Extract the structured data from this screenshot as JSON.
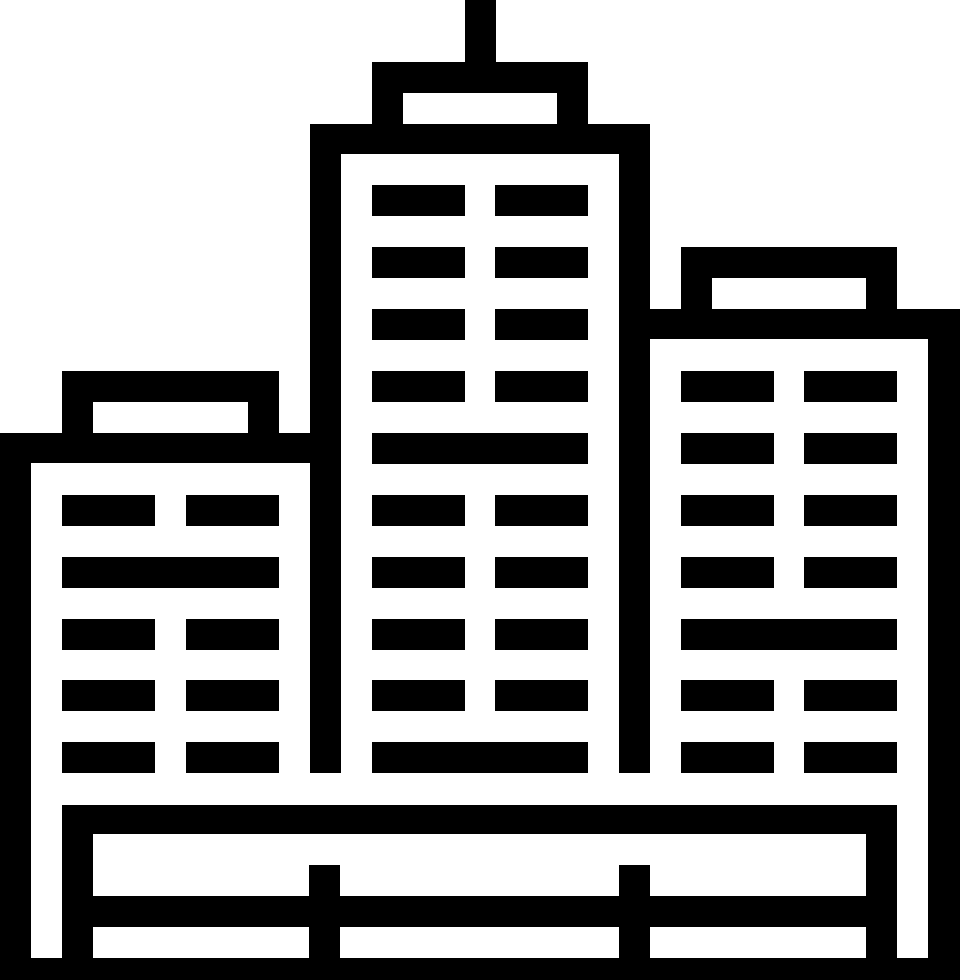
{
  "meta": {
    "canvas": {
      "width": 960,
      "height": 980
    }
  },
  "colors": {
    "foreground": "#000000",
    "background": "#ffffff"
  },
  "icon": {
    "name": "city-skyline-icon",
    "description": "Pixel-style monochrome icon of three city buildings: a tall center tower with rooftop antenna, a shorter left building, a mid-height right building, and a fence with ground band at the base.",
    "rects": [
      {
        "name": "right-building-body",
        "fill": "fg",
        "x": 650,
        "y": 309,
        "w": 310,
        "h": 649
      },
      {
        "name": "right-building-interior",
        "fill": "bg",
        "x": 650,
        "y": 339,
        "w": 278,
        "h": 619
      },
      {
        "name": "right-roof-box",
        "fill": "fg",
        "x": 681,
        "y": 247,
        "w": 216,
        "h": 62
      },
      {
        "name": "right-roof-box-opening",
        "fill": "bg",
        "x": 712,
        "y": 278,
        "w": 154,
        "h": 31
      },
      {
        "name": "center-building-body",
        "fill": "fg",
        "x": 310,
        "y": 124,
        "w": 340,
        "h": 649
      },
      {
        "name": "center-building-interior",
        "fill": "bg",
        "x": 341,
        "y": 154,
        "w": 278,
        "h": 619
      },
      {
        "name": "center-roof-cap",
        "fill": "fg",
        "x": 372,
        "y": 62,
        "w": 216,
        "h": 62
      },
      {
        "name": "center-roof-cap-opening",
        "fill": "bg",
        "x": 403,
        "y": 93,
        "w": 154,
        "h": 31
      },
      {
        "name": "antenna",
        "fill": "fg",
        "x": 465,
        "y": 0,
        "w": 31,
        "h": 62
      },
      {
        "name": "left-building-body",
        "fill": "fg",
        "x": 0,
        "y": 433,
        "w": 310,
        "h": 525
      },
      {
        "name": "left-building-interior",
        "fill": "bg",
        "x": 31,
        "y": 463,
        "w": 279,
        "h": 495
      },
      {
        "name": "left-roof-box",
        "fill": "fg",
        "x": 62,
        "y": 371,
        "w": 217,
        "h": 62
      },
      {
        "name": "left-roof-box-opening",
        "fill": "bg",
        "x": 93,
        "y": 402,
        "w": 155,
        "h": 31
      },
      {
        "name": "center-window",
        "fill": "fg",
        "x": 372,
        "y": 185,
        "w": 93,
        "h": 31
      },
      {
        "name": "center-window",
        "fill": "fg",
        "x": 495,
        "y": 185,
        "w": 93,
        "h": 31
      },
      {
        "name": "center-window",
        "fill": "fg",
        "x": 372,
        "y": 247,
        "w": 93,
        "h": 31
      },
      {
        "name": "center-window",
        "fill": "fg",
        "x": 495,
        "y": 247,
        "w": 93,
        "h": 31
      },
      {
        "name": "center-window",
        "fill": "fg",
        "x": 372,
        "y": 309,
        "w": 93,
        "h": 31
      },
      {
        "name": "center-window",
        "fill": "fg",
        "x": 495,
        "y": 309,
        "w": 93,
        "h": 31
      },
      {
        "name": "center-window",
        "fill": "fg",
        "x": 372,
        "y": 371,
        "w": 93,
        "h": 31
      },
      {
        "name": "center-window",
        "fill": "fg",
        "x": 495,
        "y": 371,
        "w": 93,
        "h": 31
      },
      {
        "name": "center-window-wide",
        "fill": "fg",
        "x": 372,
        "y": 433,
        "w": 216,
        "h": 31
      },
      {
        "name": "center-window",
        "fill": "fg",
        "x": 372,
        "y": 495,
        "w": 93,
        "h": 31
      },
      {
        "name": "center-window",
        "fill": "fg",
        "x": 495,
        "y": 495,
        "w": 93,
        "h": 31
      },
      {
        "name": "center-window",
        "fill": "fg",
        "x": 372,
        "y": 557,
        "w": 93,
        "h": 31
      },
      {
        "name": "center-window",
        "fill": "fg",
        "x": 495,
        "y": 557,
        "w": 93,
        "h": 31
      },
      {
        "name": "center-window",
        "fill": "fg",
        "x": 372,
        "y": 619,
        "w": 93,
        "h": 31
      },
      {
        "name": "center-window",
        "fill": "fg",
        "x": 495,
        "y": 619,
        "w": 93,
        "h": 31
      },
      {
        "name": "center-window",
        "fill": "fg",
        "x": 372,
        "y": 680,
        "w": 93,
        "h": 31
      },
      {
        "name": "center-window",
        "fill": "fg",
        "x": 495,
        "y": 680,
        "w": 93,
        "h": 31
      },
      {
        "name": "center-window-wide",
        "fill": "fg",
        "x": 372,
        "y": 742,
        "w": 216,
        "h": 31
      },
      {
        "name": "left-window",
        "fill": "fg",
        "x": 62,
        "y": 495,
        "w": 93,
        "h": 31
      },
      {
        "name": "left-window",
        "fill": "fg",
        "x": 186,
        "y": 495,
        "w": 93,
        "h": 31
      },
      {
        "name": "left-window-wide",
        "fill": "fg",
        "x": 62,
        "y": 557,
        "w": 217,
        "h": 31
      },
      {
        "name": "left-window",
        "fill": "fg",
        "x": 62,
        "y": 619,
        "w": 93,
        "h": 31
      },
      {
        "name": "left-window",
        "fill": "fg",
        "x": 186,
        "y": 619,
        "w": 93,
        "h": 31
      },
      {
        "name": "left-window",
        "fill": "fg",
        "x": 62,
        "y": 680,
        "w": 93,
        "h": 31
      },
      {
        "name": "left-window",
        "fill": "fg",
        "x": 186,
        "y": 680,
        "w": 93,
        "h": 31
      },
      {
        "name": "left-window",
        "fill": "fg",
        "x": 62,
        "y": 742,
        "w": 93,
        "h": 31
      },
      {
        "name": "left-window",
        "fill": "fg",
        "x": 186,
        "y": 742,
        "w": 93,
        "h": 31
      },
      {
        "name": "right-window",
        "fill": "fg",
        "x": 681,
        "y": 371,
        "w": 93,
        "h": 31
      },
      {
        "name": "right-window",
        "fill": "fg",
        "x": 804,
        "y": 371,
        "w": 93,
        "h": 31
      },
      {
        "name": "right-window",
        "fill": "fg",
        "x": 681,
        "y": 433,
        "w": 93,
        "h": 31
      },
      {
        "name": "right-window",
        "fill": "fg",
        "x": 804,
        "y": 433,
        "w": 93,
        "h": 31
      },
      {
        "name": "right-window",
        "fill": "fg",
        "x": 681,
        "y": 495,
        "w": 93,
        "h": 31
      },
      {
        "name": "right-window",
        "fill": "fg",
        "x": 804,
        "y": 495,
        "w": 93,
        "h": 31
      },
      {
        "name": "right-window",
        "fill": "fg",
        "x": 681,
        "y": 557,
        "w": 93,
        "h": 31
      },
      {
        "name": "right-window",
        "fill": "fg",
        "x": 804,
        "y": 557,
        "w": 93,
        "h": 31
      },
      {
        "name": "right-window-wide",
        "fill": "fg",
        "x": 681,
        "y": 619,
        "w": 216,
        "h": 31
      },
      {
        "name": "right-window",
        "fill": "fg",
        "x": 681,
        "y": 680,
        "w": 93,
        "h": 31
      },
      {
        "name": "right-window",
        "fill": "fg",
        "x": 804,
        "y": 680,
        "w": 93,
        "h": 31
      },
      {
        "name": "right-window",
        "fill": "fg",
        "x": 681,
        "y": 742,
        "w": 93,
        "h": 31
      },
      {
        "name": "right-window",
        "fill": "fg",
        "x": 804,
        "y": 742,
        "w": 93,
        "h": 31
      },
      {
        "name": "fence-top-rail",
        "fill": "fg",
        "x": 62,
        "y": 805,
        "w": 835,
        "h": 29
      },
      {
        "name": "fence-left-post",
        "fill": "fg",
        "x": 62,
        "y": 805,
        "w": 31,
        "h": 153
      },
      {
        "name": "fence-right-post",
        "fill": "fg",
        "x": 866,
        "y": 805,
        "w": 31,
        "h": 153
      },
      {
        "name": "fence-mid-post-left",
        "fill": "fg",
        "x": 309,
        "y": 865,
        "w": 31,
        "h": 93
      },
      {
        "name": "fence-mid-post-right",
        "fill": "fg",
        "x": 619,
        "y": 865,
        "w": 31,
        "h": 93
      },
      {
        "name": "fence-bottom-rail",
        "fill": "fg",
        "x": 62,
        "y": 896,
        "w": 835,
        "h": 31
      },
      {
        "name": "ground-band",
        "fill": "fg",
        "x": 0,
        "y": 958,
        "w": 960,
        "h": 22
      }
    ]
  }
}
